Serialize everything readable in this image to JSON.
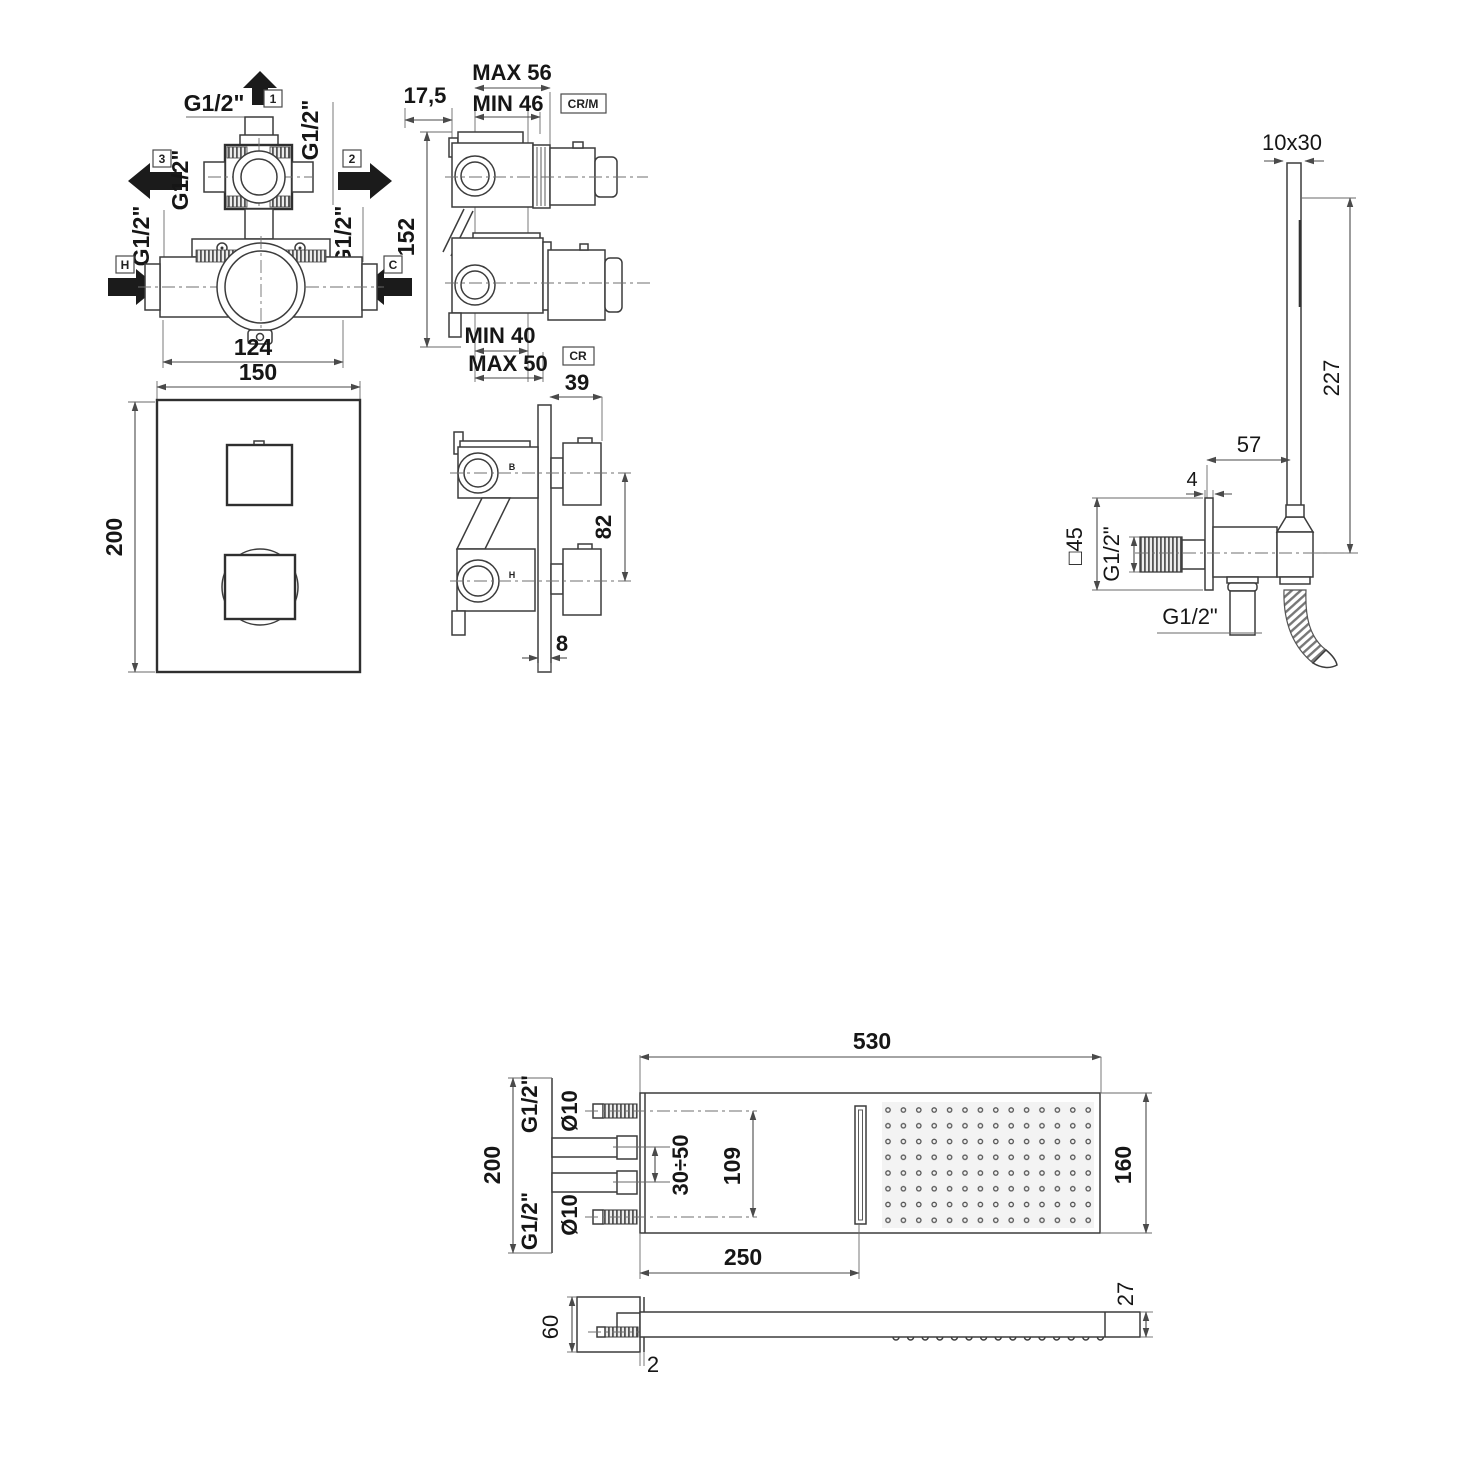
{
  "colors": {
    "line": "#3c3c3c",
    "dim": "#4a4a4a",
    "text": "#161616",
    "background": "#ffffff",
    "dot_field": "#f3f3f3"
  },
  "mixer_front": {
    "thread": "G1/2\"",
    "port_1": "1",
    "port_2": "2",
    "port_3": "3",
    "port_hot": "H",
    "port_cold": "C",
    "dim_body": "124"
  },
  "mixer_plate": {
    "dim_width": "150",
    "dim_height": "200"
  },
  "mixer_side_rough": {
    "dim_offset": "17,5",
    "dim_max_top": "MAX 56",
    "dim_min_top": "MIN 46",
    "finish_code_top": "CR/M",
    "dim_height": "152",
    "dim_min_bottom": "MIN 40",
    "dim_max_bottom": "MAX 50",
    "finish_code_bottom": "CR"
  },
  "mixer_side_finished": {
    "dim_knob_depth": "39",
    "dim_handle_centers": "82",
    "dim_plate_thickness": "8",
    "port_top": "B",
    "port_bottom": "H"
  },
  "handshower": {
    "dim_section": "10x30",
    "dim_length": "227",
    "dim_offset": "57",
    "dim_flange_thickness": "4",
    "dim_flange_size": "□45",
    "thread_wall": "G1/2\"",
    "thread_outlet": "G1/2\""
  },
  "showerhead": {
    "dim_width": "530",
    "dim_bracket_height": "200",
    "dim_depth": "160",
    "dim_slot_offset": "250",
    "dim_inlet_centers": "109",
    "dim_adjust_range": "30÷50",
    "pipe_top": "Ø10",
    "pipe_bottom": "Ø10",
    "thread_top": "G1/2\"",
    "thread_bottom": "G1/2\"",
    "dim_thickness": "27",
    "dim_block_height": "60",
    "dim_face_thickness": "2"
  }
}
